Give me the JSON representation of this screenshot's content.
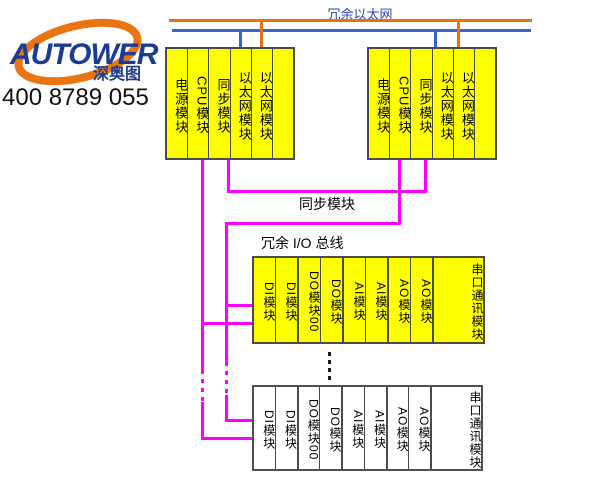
{
  "logo": {
    "brand": "AUTOWER",
    "cn_name": "深奥图",
    "phone": "400 8789 055"
  },
  "diagram": {
    "ethernet_label": "冗余以太网",
    "sync_label": "同步模块",
    "io_bus_label": "冗余 I/O 总线",
    "controller_rack": {
      "modules": [
        "电源模块",
        "CPU模块",
        "同步模块",
        "以太网模块",
        "以太网模块",
        ""
      ]
    },
    "io_rack": {
      "modules": [
        "DI模块",
        "DI模块",
        "DO模块00",
        "DO模块",
        "AI模块",
        "AI模块",
        "AO模块",
        "AO模块",
        "串口通讯模块"
      ]
    },
    "colors": {
      "ethernet_bus_a": "#E8720B",
      "ethernet_bus_b": "#3A66CC",
      "sync_io_bus": "#FF00FF",
      "module_fill": "#FFFF00",
      "ethernet_label_blue": "#2B3FBF",
      "logo_navy": "#1C3C94",
      "logo_orange": "#E87511"
    }
  }
}
